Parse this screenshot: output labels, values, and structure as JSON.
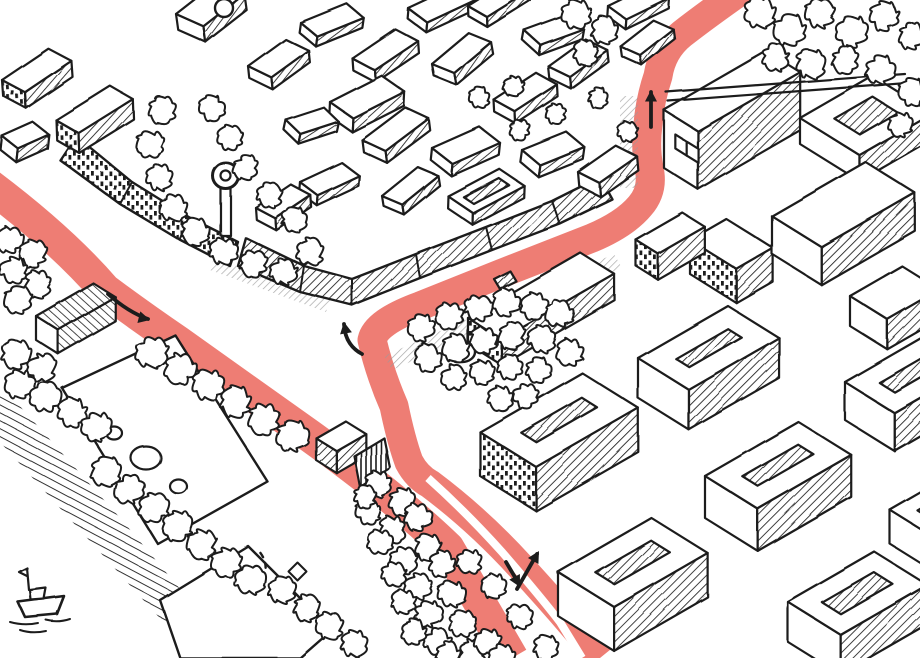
{
  "meta": {
    "kind": "hand-drawn-isometric-city-map",
    "canvas": {
      "w": 920,
      "h": 658
    }
  },
  "colors": {
    "paper": "#ffffff",
    "ink": "#1c1c1c",
    "route": "#ee7d74",
    "shadow": "#9b9b9b"
  },
  "route": {
    "west_d": "M-15,182 Q60,238 105,290 Q140,316 178,342 L310,436 Q395,497 448,548 L512,658",
    "west_w": 33,
    "main_d": "M742,-10 Q705,16 682,34 Q662,50 658,76 Q650,100 648,124 Q645,148 649,168 Q654,190 640,206 Q625,224 592,238 L500,274 L420,306 Q376,322 372,340 Q380,374 394,406 Q401,440 409,462 Q417,477 430,484 Q478,520 520,566 Q565,615 600,658",
    "main_w": 29,
    "divider_d": "M428,478 Q466,512 502,552 Q540,596 560,622 L582,658",
    "divider_w": 8
  },
  "arrows": [
    {
      "name": "arrow-west-eastbound",
      "d": "M108,294 Q128,312 148,319",
      "tip": [
        150,
        320
      ],
      "ang": 14
    },
    {
      "name": "arrow-junction-turn",
      "d": "M362,354 Q345,345 344,324",
      "tip": [
        344,
        322
      ],
      "ang": -100
    },
    {
      "name": "arrow-north-up",
      "d": "M651,127 L651,92",
      "tip": [
        651,
        90
      ],
      "ang": -90
    },
    {
      "name": "arrow-bottom-up",
      "d": "M517,589 L537,554",
      "tip": [
        539,
        551
      ],
      "ang": -60
    },
    {
      "name": "arrow-bottom-down",
      "d": "M506,562 L519,584",
      "tip": [
        520,
        587
      ],
      "ang": 62
    }
  ],
  "shadows": [
    {
      "pts": "384,356 614,254 622,268 392,370"
    },
    {
      "pts": "620,96 638,96 638,188 620,188"
    },
    {
      "pts": "214,258 330,300 326,312 210,270"
    }
  ],
  "bank": {
    "pts": "0,396 18,404 122,520 238,658 196,658 0,442"
  },
  "lawns": [
    {
      "pts": "62,388 175,335 268,482 158,544"
    },
    {
      "pts": "160,600 248,546 332,630 300,658 180,658"
    }
  ],
  "strips": [
    {
      "out": [
        [
          238,
          266
        ],
        [
          300,
          292
        ],
        [
          352,
          305
        ],
        [
          420,
          278
        ],
        [
          492,
          250
        ],
        [
          560,
          224
        ],
        [
          612,
          199
        ]
      ],
      "in": [
        [
          246,
          238
        ],
        [
          304,
          266
        ],
        [
          352,
          279
        ],
        [
          416,
          254
        ],
        [
          486,
          227
        ],
        [
          552,
          201
        ],
        [
          600,
          177
        ]
      ],
      "f": "a"
    },
    {
      "out": [
        [
          60,
          160
        ],
        [
          120,
          204
        ],
        [
          180,
          240
        ],
        [
          230,
          266
        ]
      ],
      "in": [
        [
          76,
          136
        ],
        [
          132,
          182
        ],
        [
          190,
          218
        ],
        [
          238,
          242
        ]
      ],
      "f": "d"
    }
  ],
  "boxes": [
    {
      "x": 248,
      "y": 66,
      "w": 46,
      "d": 26,
      "h": 12,
      "rot": -6
    },
    {
      "x": 300,
      "y": 22,
      "w": 50,
      "d": 22,
      "h": 10,
      "rot": 8
    },
    {
      "x": 352,
      "y": 58,
      "w": 52,
      "d": 26,
      "h": 12,
      "rot": -4,
      "se": "a"
    },
    {
      "x": 408,
      "y": 8,
      "w": 54,
      "d": 24,
      "h": 10,
      "rot": 5
    },
    {
      "x": 432,
      "y": 64,
      "w": 48,
      "d": 24,
      "h": 12,
      "rot": -10
    },
    {
      "x": 468,
      "y": 6,
      "w": 50,
      "d": 22,
      "h": 10,
      "rot": -2
    },
    {
      "x": 524,
      "y": 30,
      "w": 46,
      "d": 22,
      "h": 10,
      "rot": 10
    },
    {
      "x": 548,
      "y": 66,
      "w": 46,
      "d": 24,
      "h": 12,
      "rot": -6
    },
    {
      "x": 608,
      "y": 6,
      "w": 48,
      "d": 22,
      "h": 10,
      "rot": 4
    },
    {
      "x": 620,
      "y": 46,
      "w": 42,
      "d": 22,
      "h": 10,
      "rot": -8
    },
    {
      "x": 330,
      "y": 102,
      "w": 58,
      "d": 28,
      "h": 14,
      "rot": 3
    },
    {
      "x": 362,
      "y": 140,
      "w": 54,
      "d": 26,
      "h": 12,
      "rot": -7
    },
    {
      "x": 432,
      "y": 148,
      "w": 52,
      "d": 26,
      "h": 12,
      "rot": 6
    },
    {
      "x": 494,
      "y": 100,
      "w": 50,
      "d": 24,
      "h": 12,
      "rot": -3
    },
    {
      "x": 522,
      "y": 150,
      "w": 48,
      "d": 24,
      "h": 12,
      "rot": 8
    },
    {
      "x": 578,
      "y": 172,
      "w": 46,
      "d": 24,
      "h": 14,
      "rot": -5
    },
    {
      "x": 448,
      "y": 196,
      "w": 58,
      "d": 30,
      "h": 12,
      "rot": 2,
      "court": 9
    },
    {
      "x": 382,
      "y": 196,
      "w": 46,
      "d": 22,
      "h": 10,
      "rot": -9
    },
    {
      "x": 300,
      "y": 182,
      "w": 46,
      "d": 22,
      "h": 10,
      "rot": 5
    },
    {
      "x": 256,
      "y": 208,
      "w": 42,
      "d": 22,
      "h": 12,
      "rot": -4
    },
    {
      "x": 286,
      "y": 120,
      "w": 40,
      "d": 20,
      "h": 10,
      "rot": 12
    },
    {
      "x": 2,
      "y": 80,
      "w": 56,
      "d": 26,
      "h": 16,
      "rot": -4,
      "sw": "d"
    },
    {
      "x": 56,
      "y": 120,
      "w": 64,
      "d": 26,
      "h": 20,
      "rot": -2,
      "sw": "d"
    },
    {
      "x": 2,
      "y": 136,
      "w": 34,
      "d": 20,
      "h": 14,
      "rot": 6
    },
    {
      "x": 176,
      "y": 14,
      "w": 52,
      "d": 30,
      "h": 16,
      "rot": -8,
      "se": "a"
    },
    {
      "x": 664,
      "y": 110,
      "w": 118,
      "d": 40,
      "h": 58,
      "win": 2,
      "se": "a"
    },
    {
      "x": 800,
      "y": 118,
      "w": 84,
      "d": 70,
      "h": 26,
      "court": 20
    },
    {
      "x": 690,
      "y": 240,
      "w": 42,
      "d": 55,
      "h": 34,
      "sw": "d",
      "se": "a"
    },
    {
      "x": 772,
      "y": 216,
      "w": 108,
      "d": 58,
      "h": 38,
      "se": "a"
    },
    {
      "x": 850,
      "y": 296,
      "w": 60,
      "d": 44,
      "h": 30,
      "se": "a"
    },
    {
      "x": 636,
      "y": 240,
      "w": 54,
      "d": 26,
      "h": 26,
      "sw": "d"
    },
    {
      "x": 468,
      "y": 318,
      "w": 130,
      "d": 40,
      "h": 26,
      "sw": "d",
      "se": "a"
    },
    {
      "x": 480,
      "y": 432,
      "w": 118,
      "d": 66,
      "h": 44,
      "court": 24,
      "sw": "d"
    },
    {
      "x": 558,
      "y": 572,
      "w": 108,
      "d": 66,
      "h": 44,
      "court": 22
    },
    {
      "x": 638,
      "y": 358,
      "w": 104,
      "d": 60,
      "h": 40,
      "court": 22
    },
    {
      "x": 705,
      "y": 476,
      "w": 108,
      "d": 62,
      "h": 42,
      "court": 22
    },
    {
      "x": 788,
      "y": 602,
      "w": 100,
      "d": 62,
      "h": 40,
      "court": 20
    },
    {
      "x": 845,
      "y": 382,
      "w": 88,
      "d": 58,
      "h": 38,
      "court": 20
    },
    {
      "x": 890,
      "y": 510,
      "w": 70,
      "d": 50,
      "h": 34,
      "court": 16
    },
    {
      "x": 36,
      "y": 316,
      "w": 66,
      "d": 26,
      "h": 24,
      "roof": "b",
      "se": "b"
    },
    {
      "x": 316,
      "y": 438,
      "w": 34,
      "d": 24,
      "h": 22,
      "sw": "a"
    }
  ],
  "trees": [
    [
      576,
      14,
      13
    ],
    [
      604,
      30,
      12
    ],
    [
      585,
      52,
      11
    ],
    [
      760,
      12,
      14
    ],
    [
      790,
      30,
      14
    ],
    [
      820,
      14,
      13
    ],
    [
      852,
      32,
      14
    ],
    [
      884,
      16,
      13
    ],
    [
      912,
      36,
      12
    ],
    [
      776,
      58,
      12
    ],
    [
      810,
      64,
      13
    ],
    [
      845,
      60,
      12
    ],
    [
      880,
      70,
      13
    ],
    [
      912,
      92,
      12
    ],
    [
      900,
      124,
      11
    ],
    [
      162,
      110,
      12
    ],
    [
      150,
      144,
      12
    ],
    [
      160,
      178,
      12
    ],
    [
      174,
      208,
      12
    ],
    [
      196,
      232,
      12
    ],
    [
      224,
      252,
      12
    ],
    [
      254,
      264,
      12
    ],
    [
      284,
      272,
      12
    ],
    [
      310,
      252,
      12
    ],
    [
      294,
      220,
      11
    ],
    [
      270,
      196,
      11
    ],
    [
      246,
      168,
      11
    ],
    [
      230,
      138,
      11
    ],
    [
      212,
      108,
      11
    ],
    [
      480,
      98,
      9
    ],
    [
      514,
      86,
      9
    ],
    [
      556,
      114,
      9
    ],
    [
      598,
      98,
      9
    ],
    [
      628,
      132,
      9
    ],
    [
      520,
      130,
      9
    ],
    [
      422,
      328,
      12
    ],
    [
      450,
      316,
      12
    ],
    [
      478,
      308,
      12
    ],
    [
      506,
      302,
      12
    ],
    [
      534,
      306,
      12
    ],
    [
      560,
      314,
      12
    ],
    [
      428,
      358,
      12
    ],
    [
      456,
      348,
      12
    ],
    [
      484,
      340,
      12
    ],
    [
      512,
      336,
      12
    ],
    [
      542,
      340,
      12
    ],
    [
      570,
      352,
      12
    ],
    [
      454,
      378,
      11
    ],
    [
      482,
      372,
      11
    ],
    [
      510,
      368,
      11
    ],
    [
      538,
      370,
      11
    ],
    [
      500,
      398,
      11
    ],
    [
      526,
      396,
      11
    ],
    [
      152,
      352,
      14
    ],
    [
      180,
      368,
      14
    ],
    [
      208,
      385,
      14
    ],
    [
      236,
      402,
      14
    ],
    [
      264,
      419,
      14
    ],
    [
      292,
      436,
      14
    ],
    [
      10,
      240,
      12
    ],
    [
      34,
      254,
      12
    ],
    [
      14,
      270,
      12
    ],
    [
      38,
      284,
      12
    ],
    [
      18,
      300,
      12
    ],
    [
      16,
      354,
      13
    ],
    [
      42,
      368,
      13
    ],
    [
      20,
      384,
      13
    ],
    [
      46,
      398,
      13
    ],
    [
      72,
      412,
      13
    ],
    [
      96,
      426,
      13
    ],
    [
      106,
      472,
      13
    ],
    [
      130,
      490,
      13
    ],
    [
      154,
      508,
      13
    ],
    [
      178,
      526,
      13
    ],
    [
      202,
      544,
      13
    ],
    [
      226,
      562,
      13
    ],
    [
      250,
      580,
      13
    ],
    [
      282,
      590,
      12
    ],
    [
      306,
      608,
      12
    ],
    [
      330,
      626,
      12
    ],
    [
      354,
      644,
      12
    ],
    [
      378,
      484,
      12
    ],
    [
      402,
      502,
      12
    ],
    [
      368,
      512,
      11
    ],
    [
      392,
      530,
      12
    ],
    [
      418,
      517,
      12
    ],
    [
      428,
      547,
      12
    ],
    [
      404,
      560,
      12
    ],
    [
      380,
      542,
      11
    ],
    [
      442,
      564,
      12
    ],
    [
      418,
      587,
      12
    ],
    [
      394,
      574,
      11
    ],
    [
      452,
      594,
      12
    ],
    [
      428,
      614,
      12
    ],
    [
      404,
      602,
      11
    ],
    [
      462,
      624,
      12
    ],
    [
      438,
      642,
      12
    ],
    [
      414,
      632,
      11
    ],
    [
      472,
      652,
      12
    ],
    [
      448,
      654,
      11
    ],
    [
      488,
      642,
      12
    ],
    [
      502,
      656,
      11
    ],
    [
      470,
      562,
      11
    ],
    [
      495,
      587,
      11
    ],
    [
      520,
      617,
      11
    ],
    [
      545,
      647,
      11
    ],
    [
      365,
      497,
      10
    ]
  ],
  "details": [
    {
      "name": "promenade-wall",
      "d": "M666,92 L905,74 M668,101 L907,83",
      "s": 2.2
    },
    {
      "name": "park-tower-pole",
      "d": "M221,189 h10 v47 h-10 Z",
      "f": "#fff",
      "s": 2.2
    },
    {
      "name": "park-tower-head",
      "d": "M226,176 m-13,0 a13,13 0 1,0 26,0 a13,13 0 1,0 -26,0",
      "f": "#fff",
      "s": 3
    },
    {
      "name": "park-tower-core",
      "d": "M226,176 m-5,0 a5,5 0 1,0 10,0 a5,5 0 1,0 -10,0",
      "f": "#fff",
      "s": 2.2
    },
    {
      "name": "castle-turret",
      "d": "M224,8 m-9,0 a9,9 0 1,0 18,0 a9,9 0 1,0 -18,0",
      "f": "#fff",
      "s": 2.4
    },
    {
      "name": "roof-vent",
      "d": "M494,279 L510,271 L516,281 L500,289 Z",
      "f": "a",
      "s": 2.2
    },
    {
      "name": "square-fountain",
      "d": "M462,352 m-13,0 a13,10 0 1,0 26,0 a13,10 0 1,0 -26,0",
      "f": "#fff",
      "s": 2.4
    },
    {
      "name": "pond-small-1",
      "d": "M114,433 m-8,0 a8,6.5 0 1,0 16,0 a8,6.5 0 1,0 -16,0",
      "f": "#fff",
      "s": 2.2
    },
    {
      "name": "pond-large",
      "d": "M146,458 m-15,0 a15,11.5 0 1,0 30,0 a15,11.5 0 1,0 -30,0",
      "f": "#fff",
      "s": 2.2
    },
    {
      "name": "pond-small-2",
      "d": "M178,486 m-8.5,0 a8.5,7 0 1,0 17,0 a8.5,7 0 1,0 -17,0",
      "f": "#fff",
      "s": 2.2
    },
    {
      "name": "kiosk-fence",
      "d": "M354,456 L384,438 L390,468 L360,487 Z",
      "f": "c",
      "s": 2.2
    },
    {
      "name": "park-path-dashes",
      "d": "M246,592 C264,584 272,566 258,550",
      "s": 2.4,
      "dash": "5 6"
    },
    {
      "name": "park-marker",
      "d": "M297,562 L306,571 L297,580 L288,571 Z",
      "f": "#fff",
      "s": 2
    },
    {
      "name": "boat-hull",
      "d": "M18,602 L64,596 L57,614 L25,617 Z",
      "f": "#fff",
      "s": 2.6
    },
    {
      "name": "boat-cabin",
      "d": "M30,590 L46,588 L44,599 L31,600 Z",
      "f": "#fff",
      "s": 2.2
    },
    {
      "name": "boat-mast",
      "d": "M27,568 L29,590 M27,568 L19,572 L27,576",
      "s": 2.2
    },
    {
      "name": "boat-ripples",
      "d": "M10,622 Q24,626 38,623 M46,620 Q58,623 70,619 M20,630 Q32,634 46,631",
      "s": 2
    }
  ]
}
